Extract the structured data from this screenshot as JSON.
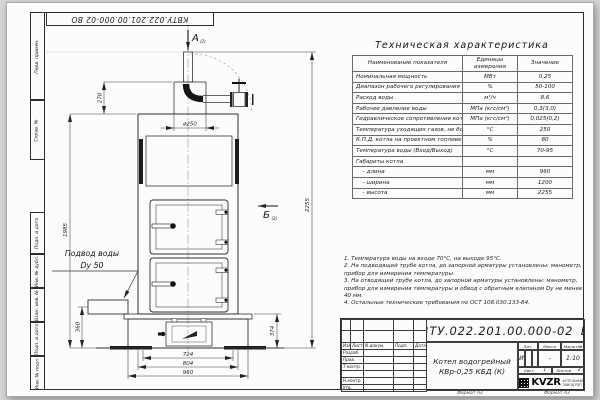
{
  "page": {
    "doc_number_top": "КВТУ.022.201.00.000-02 ВО",
    "format_note_left": "Формат А3",
    "format_note_right": "Формат А3"
  },
  "margin_labels": [
    "Перв. примен.",
    "Справ. №",
    "Подп. и дата",
    "Инв. № дубл.",
    "Взам. инв. №",
    "Подп. и дата",
    "Инв. № подл."
  ],
  "drawing": {
    "view_a": "А",
    "view_a_ref": "(2)",
    "view_b": "Б",
    "view_b_ref": "(2)",
    "inlet_line1": "Подвод воды",
    "inlet_line2": "Dу 50",
    "dim_chimney": "ø250",
    "dim_270": "270",
    "dim_1985": "1985",
    "dim_2255": "2255",
    "dim_360": "360",
    "dim_374": "374",
    "dim_724": "724",
    "dim_804": "804",
    "dim_960": "960"
  },
  "spec_table": {
    "title": "Техническая характеристика",
    "col_name": "Наименование показателя",
    "col_units": "Единицы измерения",
    "col_value": "Значение",
    "rows": [
      [
        "Номинальная мощность",
        "МВт",
        "0,25"
      ],
      [
        "Диапазон рабочего регулирования",
        "%",
        "50-100"
      ],
      [
        "Расход воды",
        "м³/ч",
        "8,6"
      ],
      [
        "Рабочее давление воды",
        "МПа (кгс/см²)",
        "0,3(3,0)"
      ],
      [
        "Гидравлическое сопротивление котла",
        "МПа (кгс/см²)",
        "0,025(0,2)"
      ],
      [
        "Температура уходящих газов, не более",
        "°С",
        "250"
      ],
      [
        "К.П.Д. котла на проектном топливе",
        "%",
        "80"
      ],
      [
        "Температура воды (Вход/Выход)",
        "°С",
        "70-95"
      ],
      [
        "Габариты котла",
        "",
        ""
      ],
      [
        "– длина",
        "мм",
        "960"
      ],
      [
        "– ширина",
        "мм",
        "1200"
      ],
      [
        "– высота",
        "мм",
        "2255"
      ]
    ]
  },
  "notes": [
    "1. Температура воды на входе 70°С, на выходе 95°С.",
    "2. На подводящей трубе котла, до запорной арматуры установлены: манометр, прибор для измерения температуры.",
    "3. На отводящей трубе котла, до запорной арматуры установлены: манометр, прибор для измерения температуры и обвод с обратным клапаном Dу не менее 40 мм.",
    "4. Остальные технические требования по ОСТ 108.030.133-84."
  ],
  "title_block": {
    "doc_number": "КВТУ.022.201.00.000-02 ВО",
    "product_line1": "Котел водогрейный",
    "product_line2": "КВр-0,25 КБД (К)",
    "hdr": [
      "Изм",
      "Лист",
      "N докум.",
      "Подп.",
      "Дата"
    ],
    "roles": [
      "Разраб.",
      "Пров.",
      "Т.контр.",
      "",
      "Н.контр.",
      "Утв."
    ],
    "lit_label": "Лит.",
    "lit_value": "И",
    "mass_label": "Масса",
    "mass_value": "-",
    "scale_label": "Масштаб",
    "scale_value": "1:10",
    "sheet_label": "Лист",
    "sheet_value": "1",
    "sheets_label": "Листов",
    "sheets_value": "2",
    "logo": "KVZR",
    "logo_sub1": "КОТЕЛЬНЫЙ",
    "logo_sub2": "ЗАВОД РЭП"
  }
}
